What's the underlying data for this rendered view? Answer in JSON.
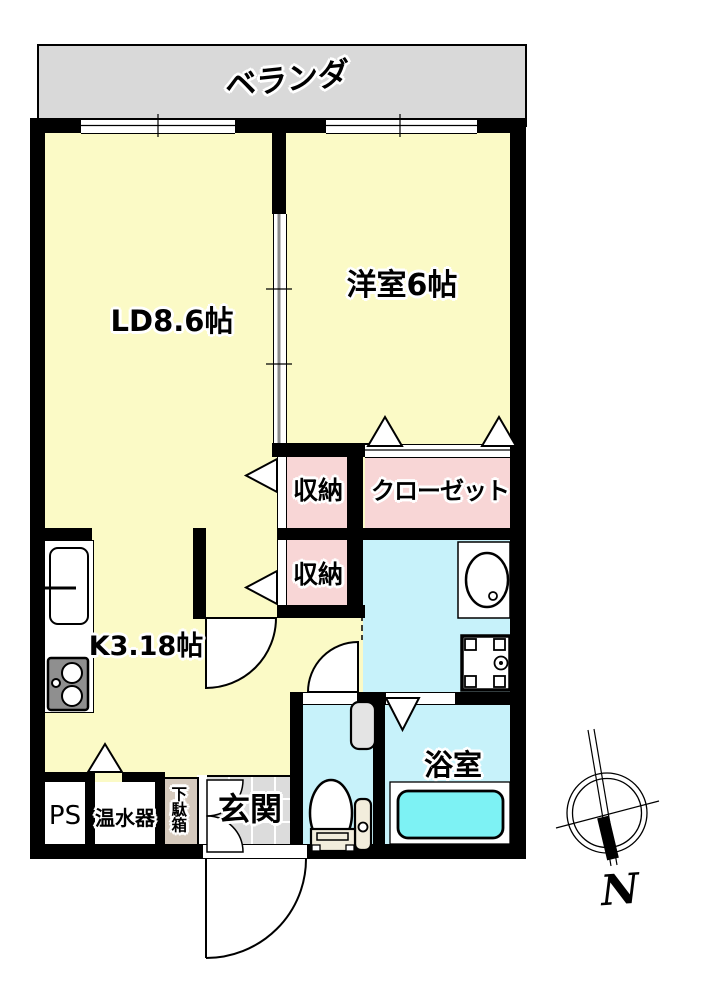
{
  "title": "1LDK apartment floor plan",
  "rooms": {
    "veranda": {
      "label": "ベランダ"
    },
    "living_dining": {
      "label": "LD8.6帖"
    },
    "western_room": {
      "label": "洋室6帖"
    },
    "storage_upper": {
      "label": "収納"
    },
    "closet": {
      "label": "クローゼット"
    },
    "storage_lower": {
      "label": "収納"
    },
    "kitchen": {
      "label": "K3.18帖"
    },
    "pipe_space": {
      "label": "PS"
    },
    "water_heater": {
      "label": "温水器"
    },
    "shoe_cabinet": {
      "label": "下駄箱"
    },
    "entrance": {
      "label": "玄関"
    },
    "bathroom": {
      "label": "浴室"
    }
  },
  "compass": {
    "north_label": "N"
  },
  "fixtures": [
    "kitchen-sink",
    "gas-stove",
    "wash-basin",
    "washing-machine-pan",
    "toilet",
    "bathtub",
    "hand-wash-tank"
  ],
  "colors": {
    "yellow": "#FBFAC6",
    "pink": "#F8D6D6",
    "cyan": "#C7F2FA",
    "tub": "#7DF2F4",
    "gray": "#D9D9D9",
    "tile": "#DCDCDC",
    "tan": "#D6CABD",
    "cream": "#F2EDDC",
    "wall": "#000000"
  }
}
